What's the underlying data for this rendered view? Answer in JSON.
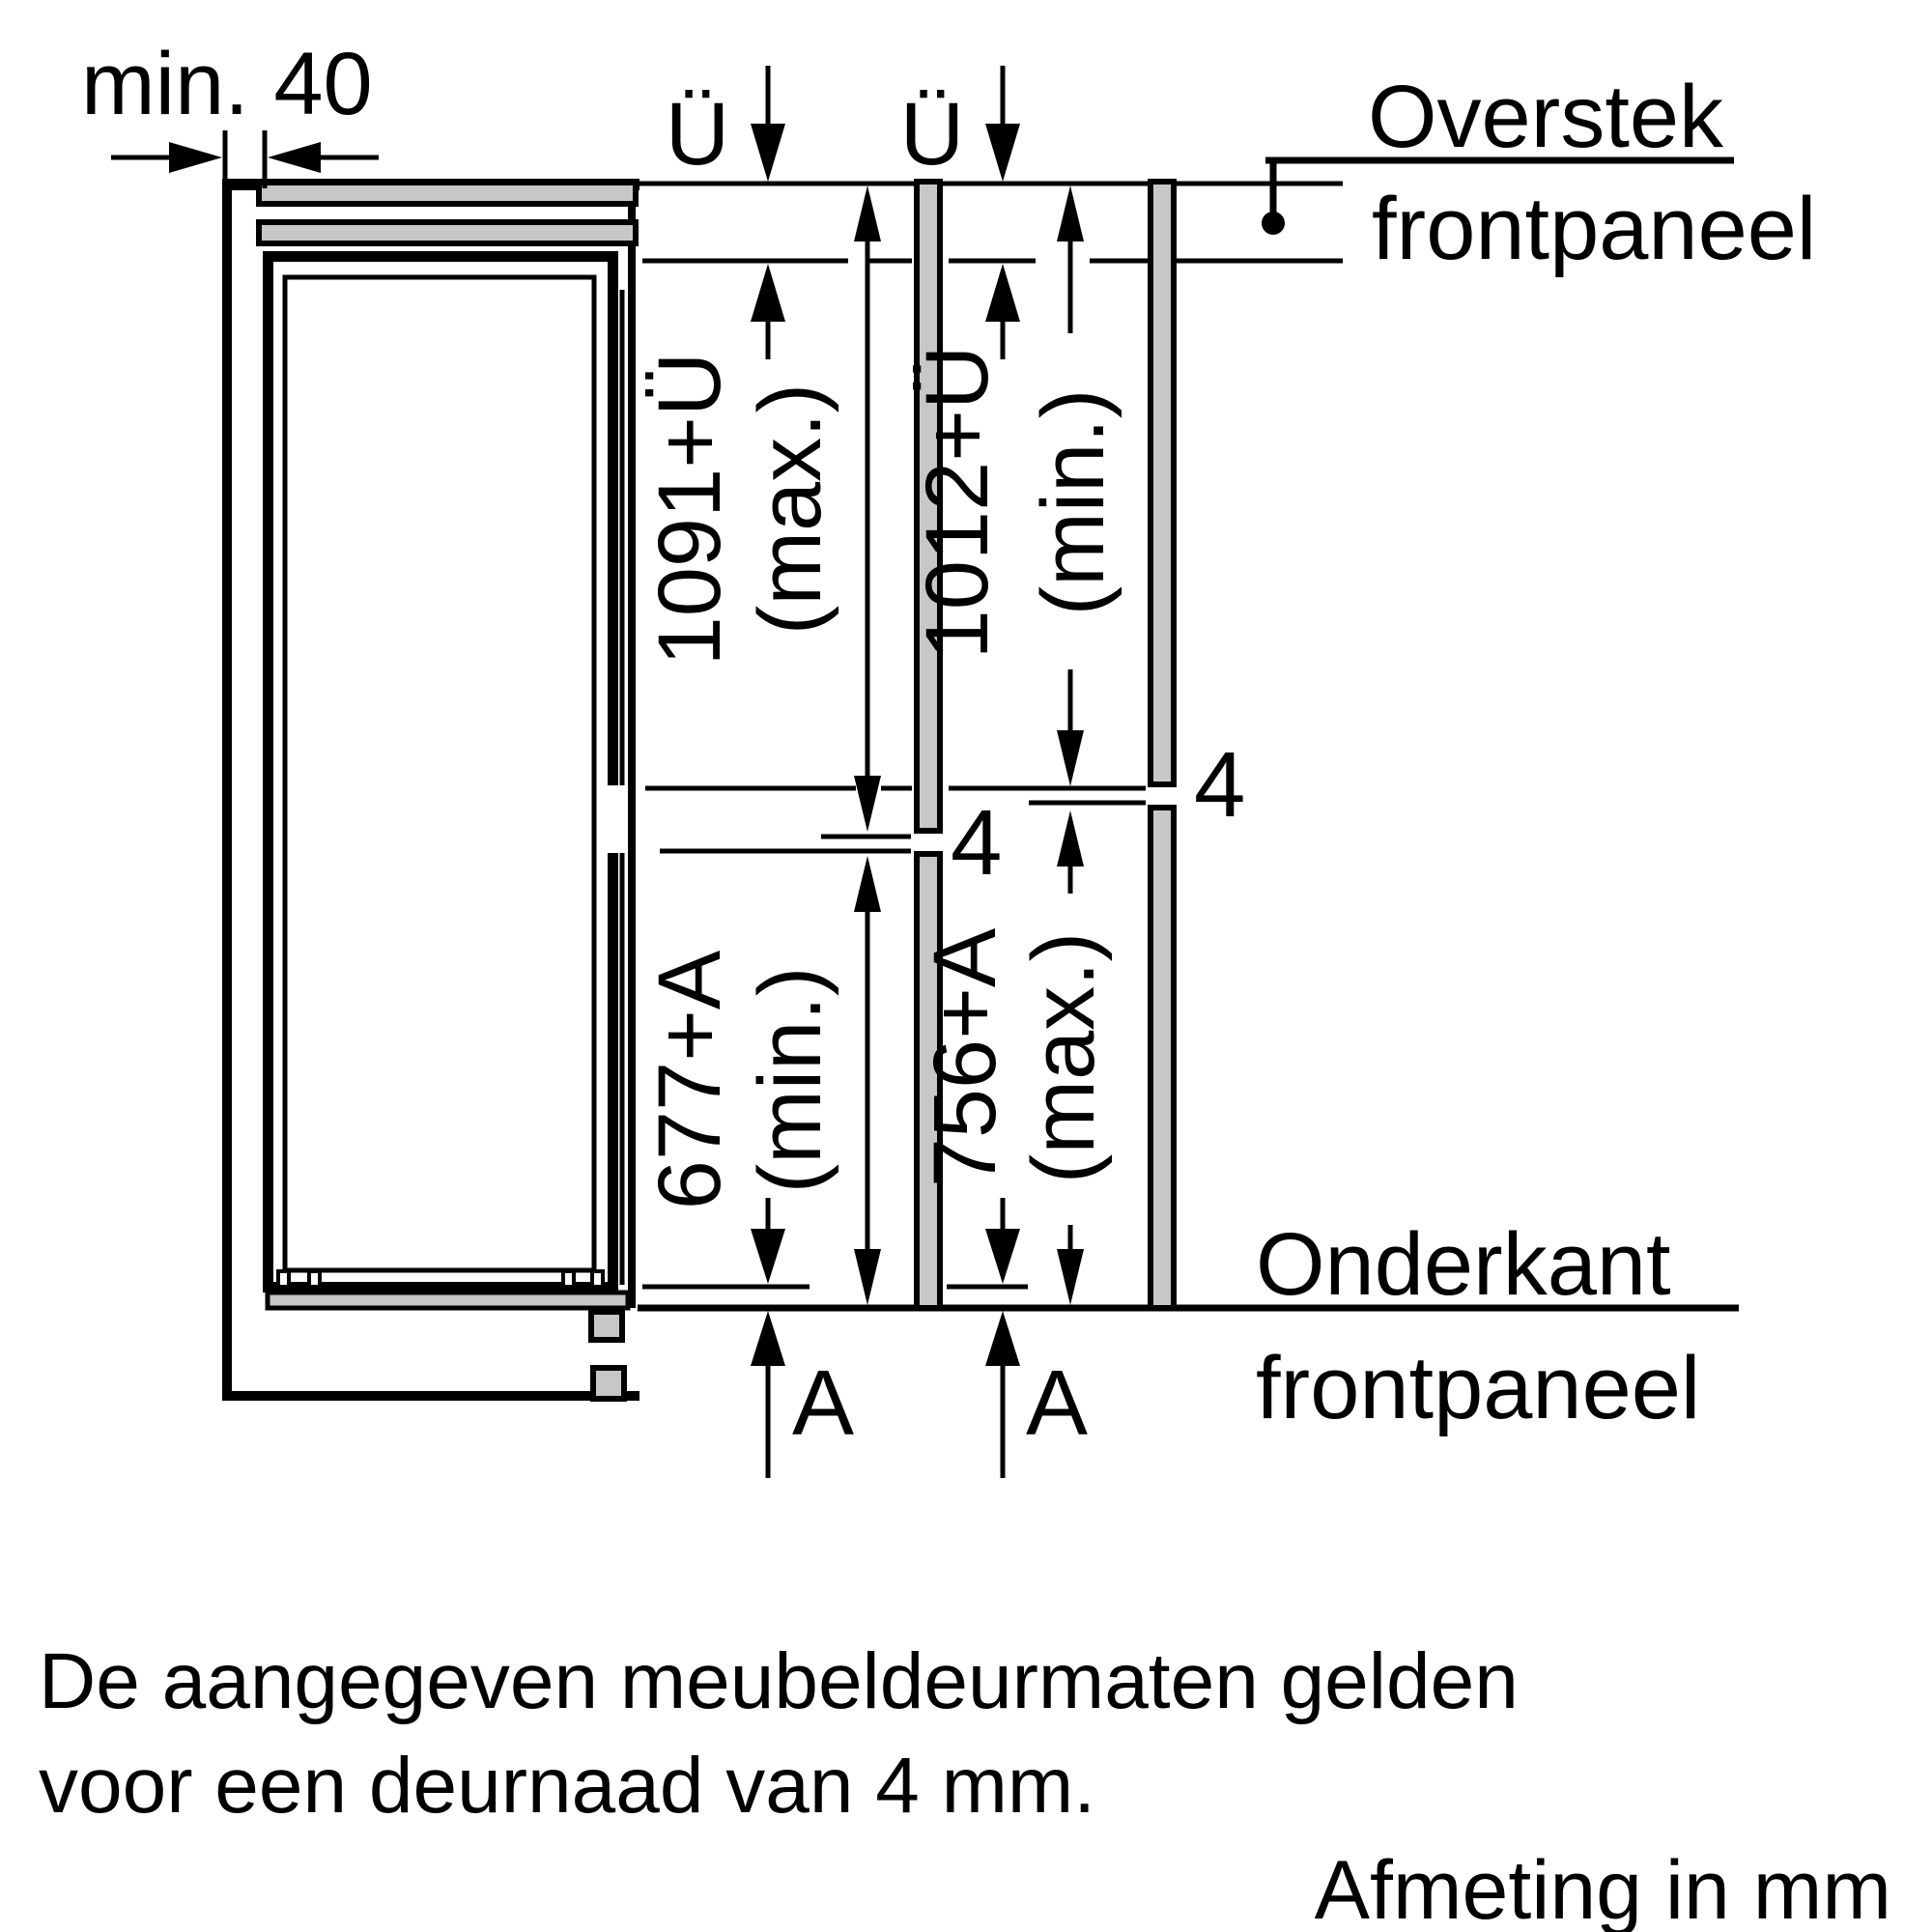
{
  "diagram": {
    "min_gap_label": "min. 40",
    "overhang_symbol_1": "Ü",
    "overhang_symbol_2": "Ü",
    "label_overstek_line1": "Overstek",
    "label_overstek_line2": "frontpaneel",
    "dim_upper_left_value": "1091+Ü",
    "dim_upper_left_qualifier": "(max.)",
    "dim_upper_right_value": "1012+Ü",
    "dim_upper_right_qualifier": "(min.)",
    "gap_value_left": "4",
    "gap_value_right": "4",
    "dim_lower_left_value": "677+A",
    "dim_lower_left_qualifier": "(min.)",
    "dim_lower_right_value": "756+A",
    "dim_lower_right_qualifier": "(max.)",
    "bottom_offset_symbol_1": "A",
    "bottom_offset_symbol_2": "A",
    "label_onderkant_line1": "Onderkant",
    "label_onderkant_line2": "frontpaneel"
  },
  "notes": {
    "line1": "De aangegeven meubeldeurmaten gelden",
    "line2": "voor een deurnaad van 4 mm.",
    "units": "Afmeting in mm"
  },
  "colors": {
    "panel_gray": "#c7c7c7",
    "line_black": "#000000",
    "background": "#ffffff"
  }
}
